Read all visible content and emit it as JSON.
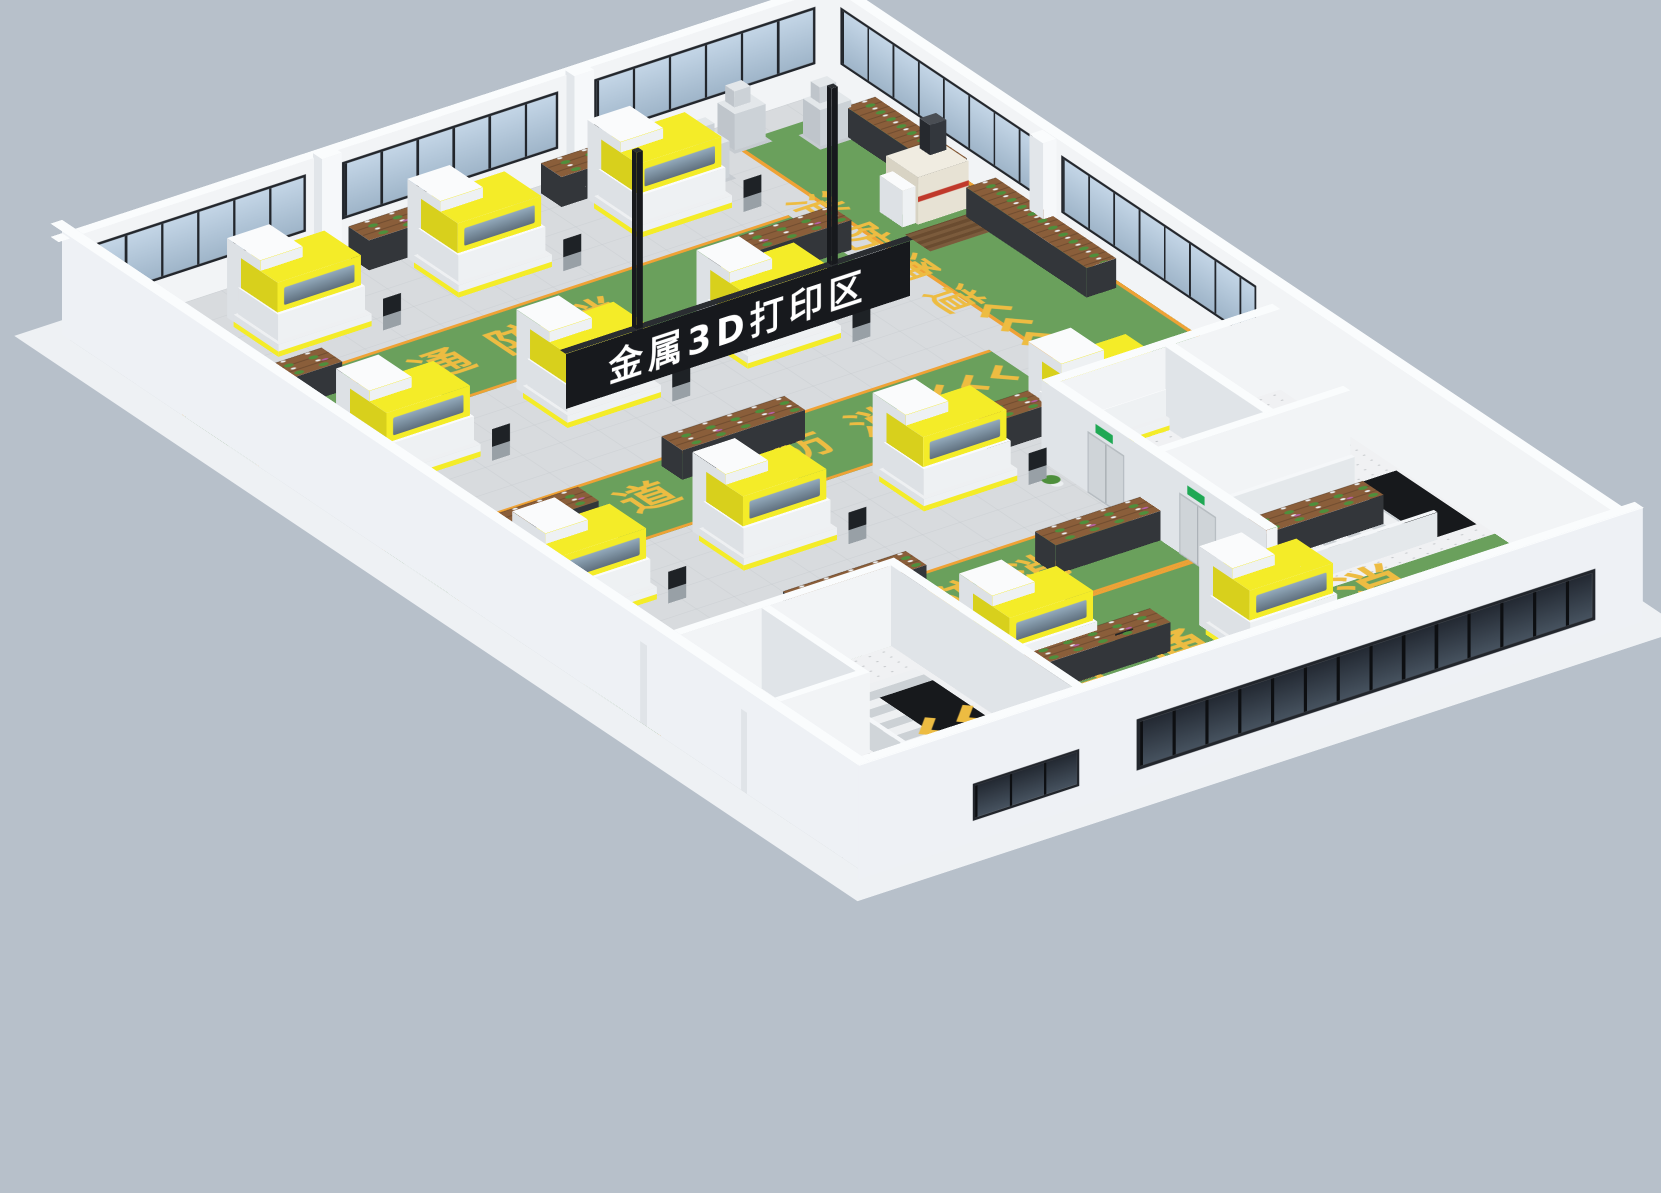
{
  "meta": {
    "title": "金属3D打印区 三维布局渲染",
    "view": "isometric-3d-factory-floor"
  },
  "texts": {
    "sign": "金属3D打印区",
    "fire_lane": "消防通道",
    "fire_lane_reversed": "道通防消"
  },
  "colors": {
    "bg": "#b7c0ca",
    "groundSlab": "#eef1f4",
    "wallWhite": "#f2f4f6",
    "wallOuter": "#eef1f5",
    "wallCap": "#fafcfd",
    "pilaster": "#f6f8fa",
    "tile": "#d8dbde",
    "tileLine": "#bec3c7",
    "green": "#6aa05c",
    "orange": "#efa235",
    "laneText": "#edbc42",
    "windowFrame": "#22262c",
    "glassTop": "#c3d5e6",
    "glassBottom": "#9fb5c9",
    "darkGlassA": "#46525f",
    "darkGlassB": "#232932",
    "machineTop": "#fafbfc",
    "machineFront": "#eef1f3",
    "machineSide": "#dde1e5",
    "hoodYellow": "#f4ec28",
    "hoodSide": "#d8d01c",
    "hoodGlassA": "#93aabc",
    "hoodGlassB": "#5f6f7d",
    "consoleStem": "#98a0a6",
    "consoleScreen": "#1e2226",
    "signBlack": "#17191d",
    "signEdge": "#2a2d31",
    "signText": "#ffffff",
    "wood": "#8a5e3a",
    "shelfFrame": "#33363a",
    "plantGreen": "#4e8f3c",
    "plantPink": "#b85fa6",
    "potWhite": "#eceff1",
    "speckleFloor": "#f0f1f3",
    "speckleDot": "#c4c7ca",
    "stairLight": "#eef0f2",
    "stairDark": "#ccd1d5",
    "hole": "#17191c",
    "railGrey": "#e4e8eb",
    "greyMachineTop": "#e3e7ea",
    "greyMachineFront": "#ccd2d7",
    "greyMachineSide": "#bfc5cb",
    "beigeTop": "#f0ece1",
    "beigeFront": "#e7e2d4",
    "beigeSide": "#d8d3c4",
    "redStripe": "#c0392b",
    "towerDarkTop": "#4a4e54",
    "towerDarkFront": "#33373d",
    "towerDarkSide": "#26292e",
    "exitGreen": "#1fa854",
    "doorGrey": "#cfd4d8",
    "matBrown": "#7b5b3c",
    "matBrownDark": "#6a4c30"
  },
  "scene": {
    "floor": {
      "w": 930,
      "d": 1380,
      "wallH": 115,
      "nearWallH": 130
    },
    "lanes_h": [
      {
        "x": 0,
        "y": 195,
        "w": 740,
        "d": 135
      },
      {
        "x": 0,
        "y": 545,
        "w": 740,
        "d": 135
      },
      {
        "x": 0,
        "y": 895,
        "w": 650,
        "d": 135
      }
    ],
    "walkway": {
      "x": 780,
      "y": 40,
      "w": 150,
      "d": 740
    },
    "bottom_green": {
      "x": 310,
      "y": 1030,
      "w": 620,
      "d": 350
    },
    "far_windows": [
      [
        20,
        268
      ],
      [
        332,
        264
      ],
      [
        640,
        270
      ]
    ],
    "right_windows": [
      [
        15,
        335
      ],
      [
        400,
        340
      ]
    ],
    "near_band": {
      "left": 340,
      "width": 560,
      "top": 20,
      "height": 58
    },
    "near_small_window": {
      "left": 140,
      "width": 130,
      "top": 24,
      "height": 42
    },
    "pilasters": [
      [
        298,
        -2,
        24,
        16,
        120
      ],
      [
        606,
        -2,
        24,
        16,
        120
      ],
      [
        908,
        376,
        16,
        24,
        120
      ]
    ],
    "machines": [
      [
        150,
        55
      ],
      [
        370,
        55
      ],
      [
        590,
        55
      ],
      [
        80,
        345
      ],
      [
        300,
        345
      ],
      [
        520,
        345
      ],
      [
        50,
        695
      ],
      [
        270,
        695
      ],
      [
        490,
        695
      ],
      [
        680,
        695
      ],
      [
        340,
        1060
      ],
      [
        570,
        1150
      ]
    ],
    "small_machines": [
      [
        620,
        28
      ],
      [
        700,
        66
      ],
      [
        775,
        22
      ],
      [
        850,
        64
      ]
    ],
    "beige_machine": {
      "x": 835,
      "y": 230
    },
    "mat": [
      812,
      296,
      96,
      44
    ],
    "shelves": [
      [
        330,
        14,
        170,
        "h"
      ],
      [
        565,
        14,
        150,
        "h"
      ],
      [
        884,
        90,
        160,
        "v"
      ],
      [
        884,
        300,
        210,
        "v"
      ],
      [
        30,
        210,
        130,
        "h"
      ],
      [
        600,
        255,
        150,
        "h"
      ],
      [
        330,
        560,
        150,
        "h"
      ],
      [
        70,
        600,
        130,
        "h"
      ],
      [
        560,
        690,
        140,
        "h"
      ],
      [
        240,
        900,
        150,
        "h"
      ],
      [
        520,
        940,
        130,
        "h"
      ],
      [
        360,
        1140,
        160,
        "h"
      ],
      [
        700,
        1040,
        150,
        "h"
      ],
      [
        420,
        1290,
        160,
        "h"
      ]
    ],
    "plant_pots": [
      [
        618,
        798
      ],
      [
        626,
        896
      ],
      [
        322,
        976
      ]
    ],
    "floor_texts": [
      {
        "x": 150,
        "y": 228,
        "fs": 60,
        "ls": 34,
        "rot": 0,
        "key": "fire_lane_reversed"
      },
      {
        "x": 250,
        "y": 578,
        "fs": 60,
        "ls": 34,
        "rot": 0,
        "key": "fire_lane_reversed"
      },
      {
        "x": 200,
        "y": 928,
        "fs": 60,
        "ls": 34,
        "rot": 0,
        "key": "fire_lane_reversed"
      },
      {
        "x": 370,
        "y": 1140,
        "fs": 74,
        "ls": 46,
        "rot": 0,
        "key": "fire_lane_reversed"
      },
      {
        "x": 800,
        "y": 170,
        "fs": 54,
        "ls": 26,
        "rot": 90,
        "key": "fire_lane"
      }
    ],
    "chevrons": [
      {
        "x": 36,
        "y": 243,
        "s": 40,
        "rot": 0
      },
      {
        "x": 100,
        "y": 594,
        "s": 40,
        "rot": 0
      },
      {
        "x": 640,
        "y": 582,
        "s": 40,
        "rot": 0
      },
      {
        "x": 66,
        "y": 944,
        "s": 40,
        "rot": 0
      },
      {
        "x": 220,
        "y": 1158,
        "s": 50,
        "rot": 0
      },
      {
        "x": 700,
        "y": 1092,
        "s": 44,
        "rot": 90
      },
      {
        "x": 806,
        "y": 470,
        "s": 40,
        "rot": 90
      },
      {
        "x": 520,
        "y": 1215,
        "s": 38,
        "rot": 0
      }
    ],
    "sign": {
      "x": 240,
      "y": 522,
      "w": 420,
      "h": 62,
      "z": 76,
      "poles": [
        326,
        564
      ]
    },
    "room_walls": [
      [
        648,
        780,
        14,
        380
      ],
      [
        648,
        768,
        282,
        14
      ],
      [
        648,
        952,
        240,
        12
      ],
      [
        790,
        780,
        12,
        176
      ],
      [
        0,
        994,
        310,
        12
      ],
      [
        298,
        1000,
        12,
        380
      ],
      [
        0,
        1170,
        150,
        10
      ],
      [
        140,
        1006,
        10,
        164
      ]
    ],
    "room_floors": [
      [
        655,
        782,
        275,
        374
      ],
      [
        4,
        1006,
        294,
        370
      ]
    ],
    "doors_on_right_block": [
      {
        "top": 70,
        "h": 64
      },
      {
        "top": 230,
        "h": 64
      }
    ],
    "stairs": [
      {
        "strip": [
          700,
          990,
          170,
          140
        ],
        "dir": "x",
        "hole": [
          868,
          990,
          58,
          140
        ],
        "rails": [
          [
            695,
            984,
            180,
            6
          ],
          [
            695,
            1128,
            180,
            6
          ]
        ]
      },
      {
        "strip": [
          160,
          1060,
          130,
          310
        ],
        "dir": "y",
        "hole": [
          225,
          1090,
          65,
          270
        ],
        "rails": [
          [
            154,
            1055,
            6,
            315
          ]
        ]
      }
    ]
  }
}
